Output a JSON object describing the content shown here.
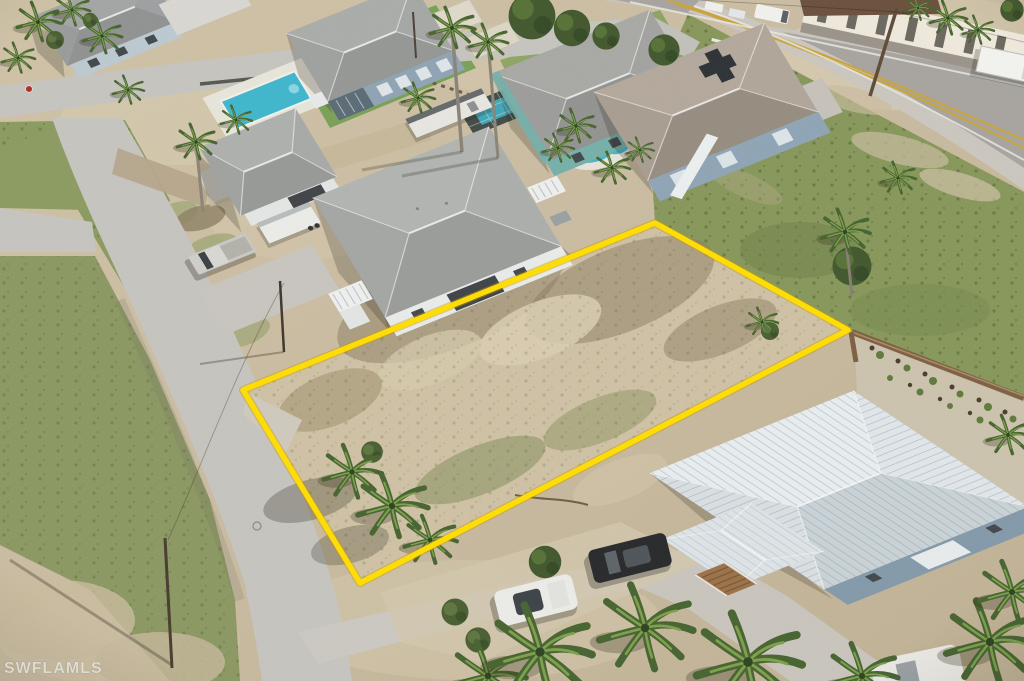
{
  "watermark": {
    "text": "SWFLAMLS"
  },
  "lot": {
    "points": "243,390 655,223 848,330 360,583",
    "outline_color": "#FFDE00"
  },
  "colors": {
    "sand": "#C9BBA0",
    "sand_light": "#DCD1B6",
    "grass": "#8A9A5F",
    "weed_field": "#87975A",
    "street_concrete": "#C6C4BF",
    "highway_asphalt": "#A7A49F",
    "center_line_yellow": "#C8A43E",
    "pool_water": "#3FB6CD",
    "metal_roof": "#DDE3E6",
    "shingle_roof": "#A4A6A4",
    "house_white": "#E9EBEA",
    "house_bluegray": "#8EA3B4",
    "house_teal": "#74B0A8",
    "fence_brown": "#7D5F41",
    "stop_sign_red": "#B32A22"
  },
  "scene": {
    "objects": [
      "vacant-lot-yellow-outline",
      "neighborhood-street",
      "coastal-highway",
      "white-stilt-house",
      "gray-roof-house",
      "two-story-bluegray-house",
      "teal-house",
      "mansion-with-kidney-pool",
      "metal-roof-house",
      "rectangular-pool",
      "caged-lap-pool",
      "pickup-truck",
      "cargo-trailer",
      "rv-trailer",
      "box-truck",
      "dark-suv",
      "white-suv",
      "white-car",
      "palm-trees",
      "weed-field",
      "wooden-privacy-fence",
      "gravel-garden",
      "utility-poles",
      "stop-sign",
      "mls-watermark"
    ]
  }
}
